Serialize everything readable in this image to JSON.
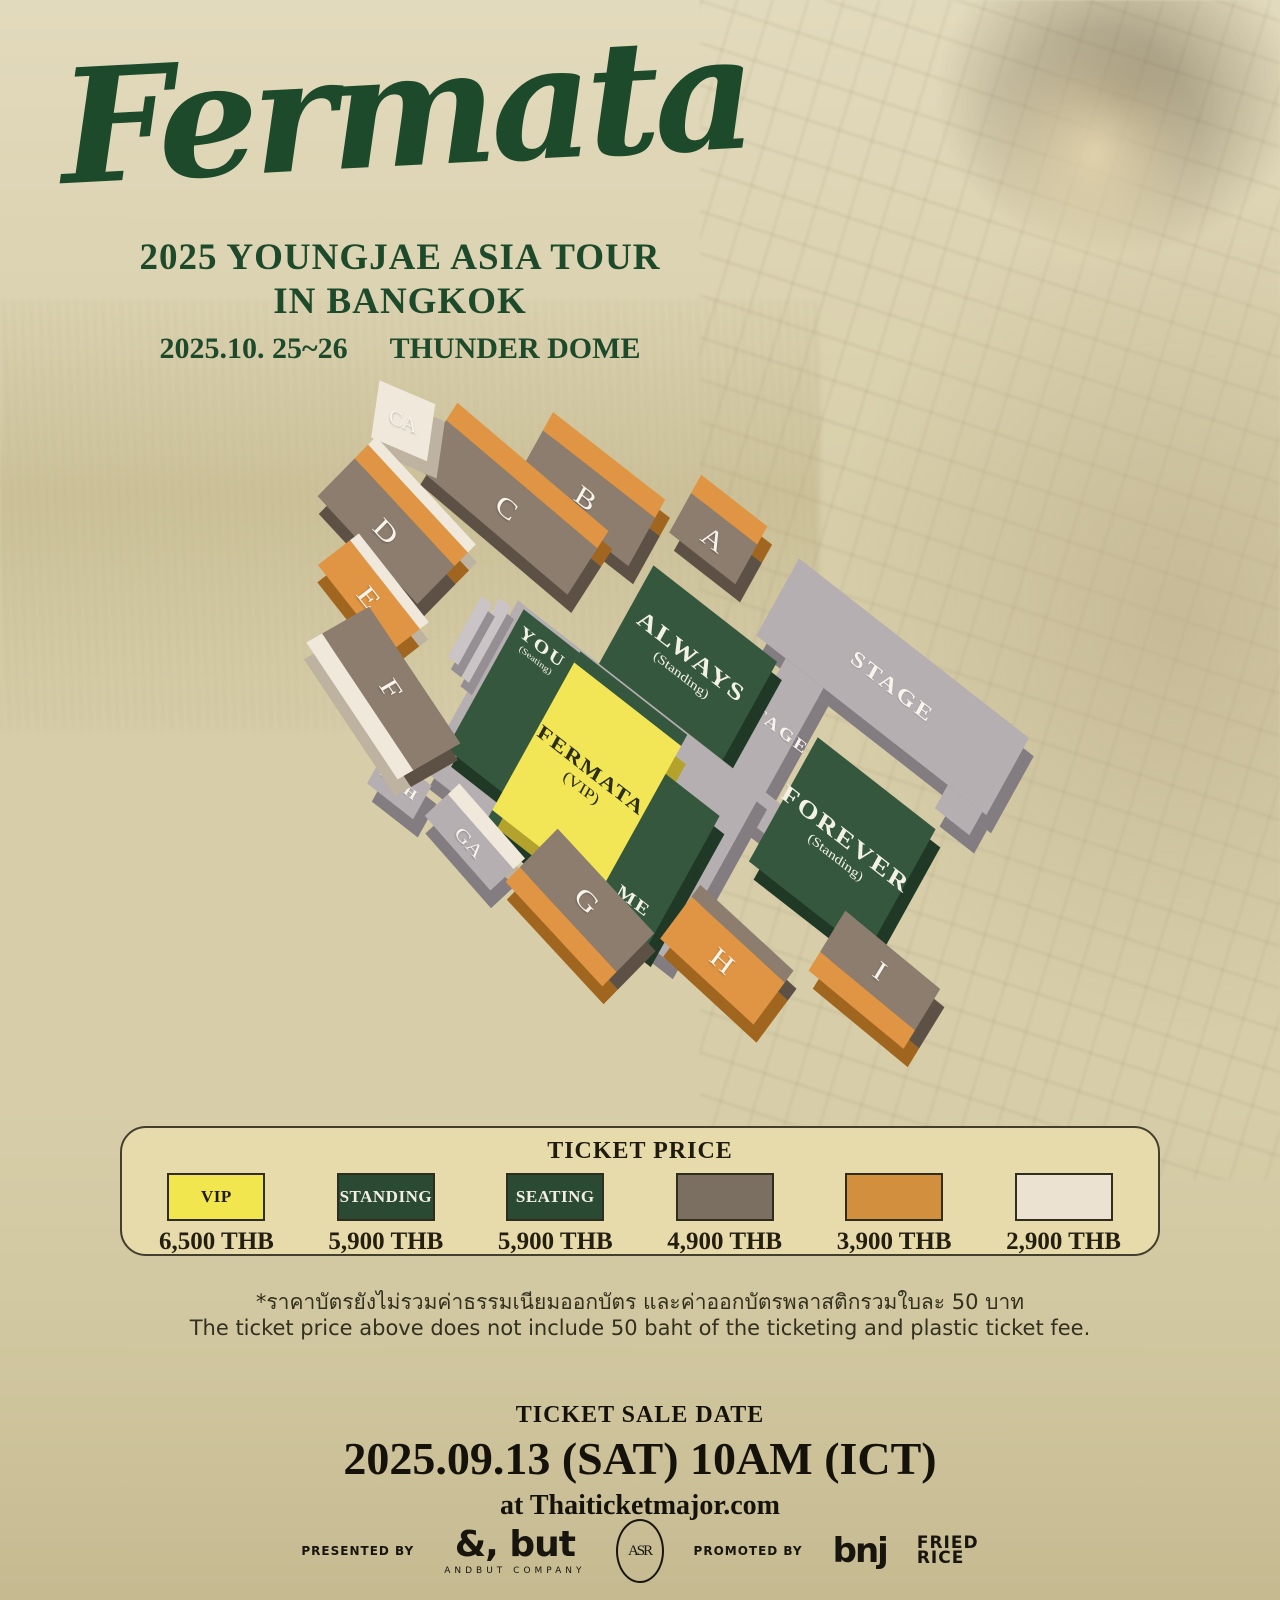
{
  "poster": {
    "title": "Fermata",
    "tour_line1": "2025 YOUNGJAE ASIA TOUR",
    "tour_line2": "IN BANGKOK",
    "date": "2025.10. 25~26",
    "venue": "THUNDER DOME"
  },
  "seatmap": {
    "stage_label": "STAGE",
    "runway_label": "STAGE",
    "foh_label": "FOH",
    "sections": [
      "A",
      "B",
      "C",
      "CA",
      "D",
      "E",
      "F",
      "GA",
      "G",
      "H",
      "I"
    ],
    "zones": {
      "always": {
        "name": "ALWAYS",
        "sub": "(Standing)"
      },
      "forever": {
        "name": "FOREVER",
        "sub": "(Standing)"
      },
      "you": {
        "name": "YOU",
        "sub": "(Seating)"
      },
      "me": {
        "name": "ME",
        "sub": "(Seating)"
      },
      "fermata": {
        "name": "FERMATA",
        "sub": "(VIP)"
      }
    }
  },
  "ticket": {
    "heading": "TICKET PRICE",
    "tiers": [
      {
        "label": "VIP",
        "price": "6,500 THB"
      },
      {
        "label": "STANDING",
        "price": "5,900 THB"
      },
      {
        "label": "SEATING",
        "price": "5,900 THB"
      },
      {
        "label": "",
        "price": "4,900 THB"
      },
      {
        "label": "",
        "price": "3,900 THB"
      },
      {
        "label": "",
        "price": "2,900 THB"
      }
    ]
  },
  "notes": {
    "thai": "*ราคาบัตรยังไม่รวมค่าธรรมเนียมออกบัตร และค่าออกบัตรพลาสติกรวมใบละ 50 บาท",
    "english": "The ticket price above does not include 50 baht of the ticketing and plastic ticket fee."
  },
  "sale": {
    "heading": "TICKET SALE DATE",
    "datetime": "2025.09.13 (SAT) 10AM (ICT)",
    "channel": "at Thaiticketmajor.com"
  },
  "footer": {
    "presented_by": "PRESENTED BY",
    "andbut": "&, but",
    "andbut_sub": "ANDBUT COMPANY",
    "monogram": "ASR",
    "promoted_by": "PROMOTED BY",
    "bnj": "bnj",
    "fried_line1": "FRIED",
    "fried_line2": "RICE"
  },
  "colors": {
    "title_green": "#1c4a2a",
    "zone_green": "#35573d",
    "vip_yellow": "#f2e657",
    "stage_gray": "#b6afb1",
    "section_brown": "#8d7d6f",
    "section_orange": "#df9543",
    "section_cream": "#f0e9db",
    "panel_beige": "#e7dbab",
    "background": "#d7cea9"
  }
}
